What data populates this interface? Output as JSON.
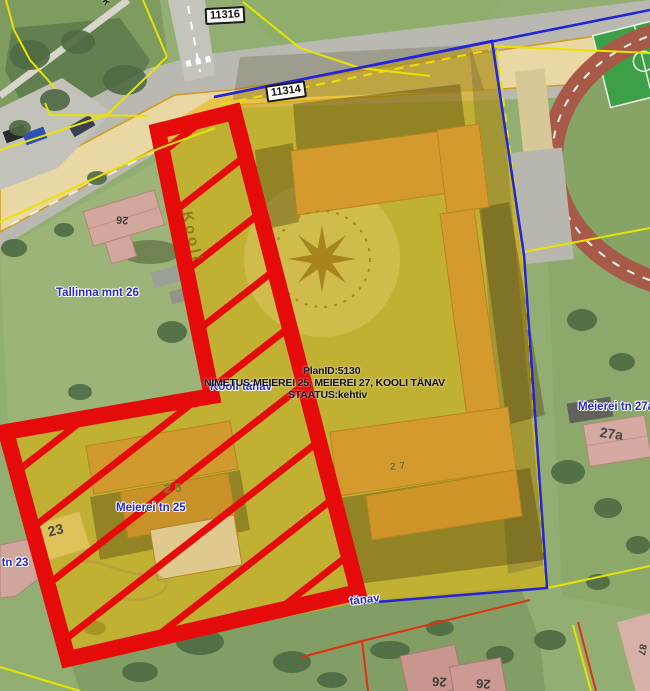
{
  "map": {
    "road_number_badges": {
      "badge_11316": "11316",
      "badge_11314": "11314"
    },
    "plan_info": {
      "plan_id": "PlanID:5130",
      "name_line": "NIMETUS:MEIEREI 25, MEIEREI 27, KOOLI TÄNAV",
      "status_line": "STAATUS:kehtiv"
    },
    "street_labels": {
      "kooli_vertical": "Kooli",
      "kooli_tanav": "Kooli tänav",
      "tanav_partial": "tänav",
      "top_partial": "lk"
    },
    "address_labels": {
      "tallinna_mnt_26": "Tallinna mnt 26",
      "meierei_tn_25": "Meierei tn 25",
      "meierei_tn_27a": "Meierei tn 27a",
      "kooli_tn_23": "li tn 23"
    },
    "parcel_numbers": {
      "parcel_25": "25",
      "parcel_27": "27",
      "parcel_27a": "27a",
      "parcel_23": "23"
    },
    "roof_numbers": {
      "tallinna_26_roof": "26",
      "bottom_left_roof": "26",
      "bottom_right_roof": "26",
      "corner_roof": "87"
    },
    "colors": {
      "plan_area_red": "#e60b0b",
      "overlay_yellow": "#e8b400",
      "boundary_blue": "#2424d8",
      "cadastral_yellow": "#e8e400",
      "address_label_blue": "#2629c8",
      "parcel_number_green": "#6f7d1f"
    }
  }
}
